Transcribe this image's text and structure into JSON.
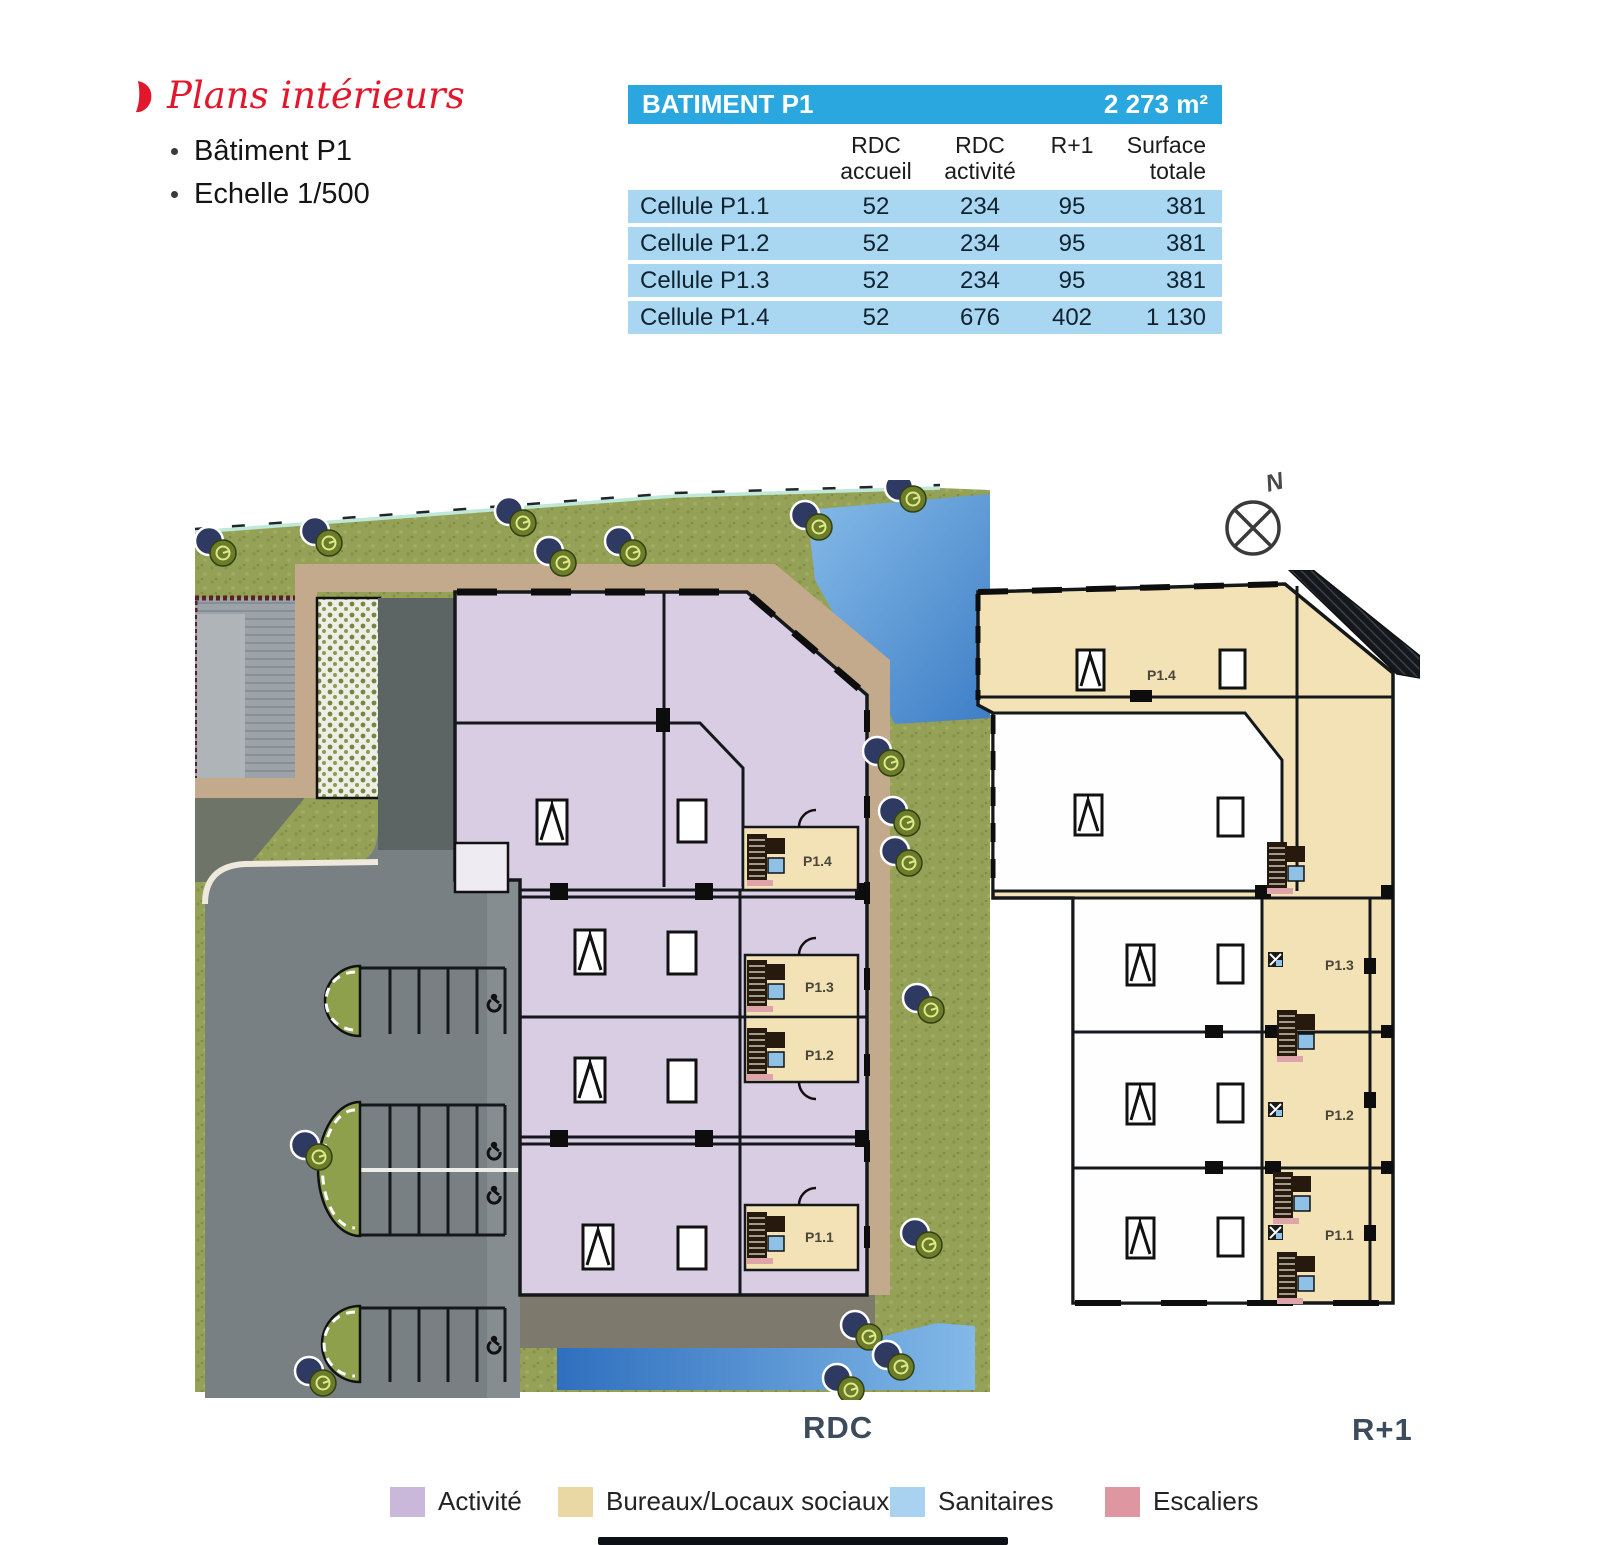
{
  "header": {
    "title": "Plans intérieurs",
    "bullets": [
      "Bâtiment P1",
      "Echelle 1/500"
    ]
  },
  "table": {
    "title": "BATIMENT P1",
    "area": "2 273 m²",
    "columns": [
      {
        "l1": "RDC",
        "l2": "accueil"
      },
      {
        "l1": "RDC",
        "l2": "activité"
      },
      {
        "l1": "R+1",
        "l2": ""
      },
      {
        "l1": "Surface",
        "l2": "totale"
      }
    ],
    "rows": [
      {
        "label": "Cellule P1.1",
        "values": [
          "52",
          "234",
          "95",
          "381"
        ]
      },
      {
        "label": "Cellule P1.2",
        "values": [
          "52",
          "234",
          "95",
          "381"
        ]
      },
      {
        "label": "Cellule P1.3",
        "values": [
          "52",
          "234",
          "95",
          "381"
        ]
      },
      {
        "label": "Cellule P1.4",
        "values": [
          "52",
          "676",
          "402",
          "1 130"
        ]
      }
    ]
  },
  "plans": {
    "rdc": {
      "caption": "RDC",
      "cells": [
        "P1.4",
        "P1.3",
        "P1.2",
        "P1.1"
      ]
    },
    "r1": {
      "caption": "R+1",
      "cells": [
        "P1.4",
        "P1.3",
        "P1.2",
        "P1.1"
      ]
    },
    "compass": "N"
  },
  "legend": {
    "items": [
      {
        "label": "Activité",
        "color": "#C9B8D9"
      },
      {
        "label": "Bureaux/Locaux sociaux",
        "color": "#EAD8A4"
      },
      {
        "label": "Sanitaires",
        "color": "#A8D2EF"
      },
      {
        "label": "Escaliers",
        "color": "#DE96A0"
      }
    ]
  },
  "colors": {
    "accent_red": "#E3172C",
    "table_header_blue": "#2AA7DF",
    "table_row_blue": "#A9D6F1",
    "activity_fill": "#D9CDE3",
    "office_fill": "#F2E2B6",
    "grass_green": "#94A156",
    "asphalt_gray": "#788084",
    "water_blue": "#4E93D6",
    "caption_slate": "#3C4C5C"
  }
}
